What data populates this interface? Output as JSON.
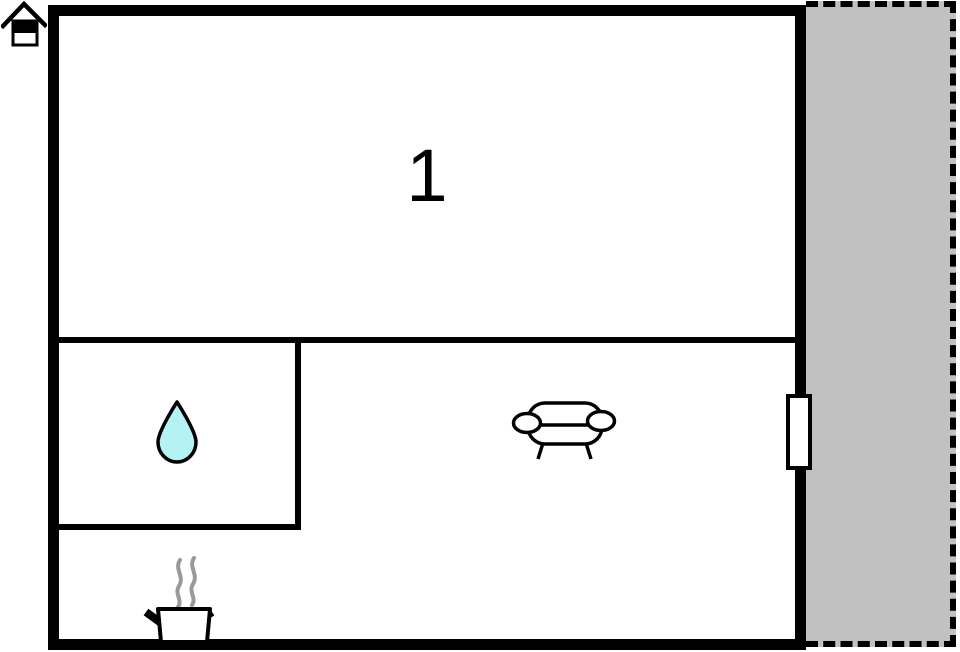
{
  "floor_plan": {
    "room_label": "1",
    "areas": {
      "main_room": "room-1",
      "small_room": "water-room",
      "living_area": "sofa-area",
      "kitchen_area": "cooking-area",
      "outdoor_area": "terrace"
    },
    "icons": {
      "home": "home-icon",
      "water_drop": "water-drop-icon",
      "sofa": "sofa-icon",
      "cooking_pot": "cooking-pot-icon"
    },
    "colors": {
      "wall": "#000000",
      "background": "#ffffff",
      "terrace_fill": "#c1c1c1",
      "water_drop_fill": "#b4f2f4",
      "steam_gray": "#999999"
    }
  }
}
